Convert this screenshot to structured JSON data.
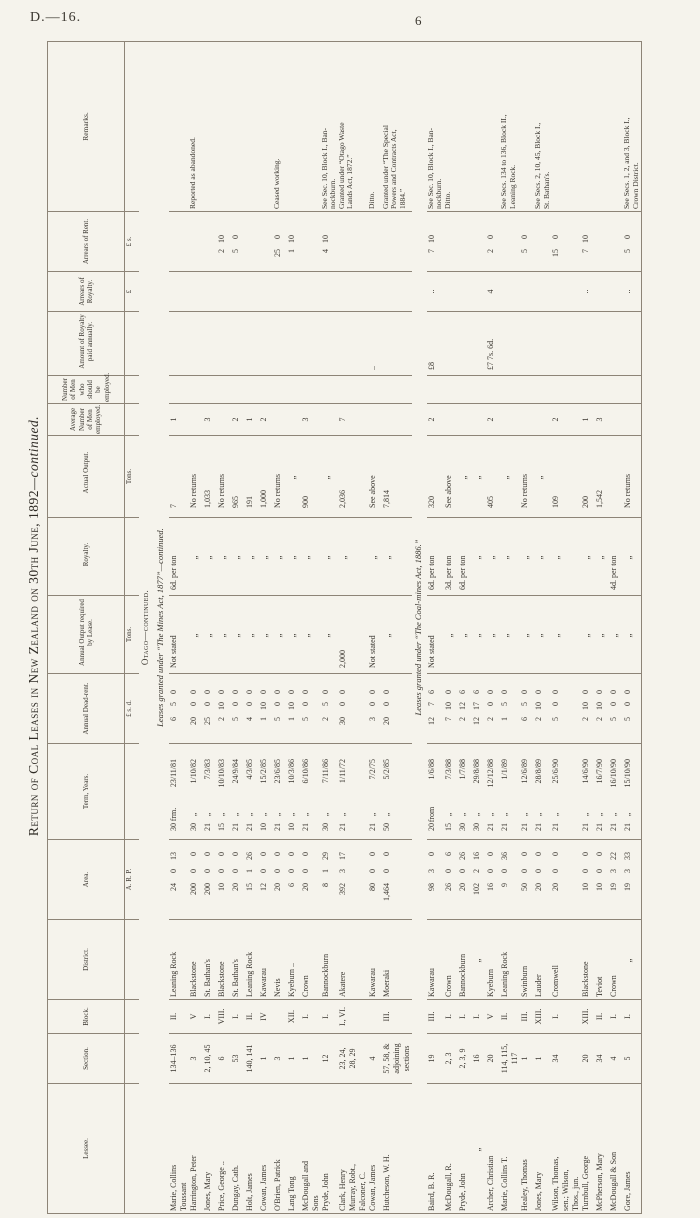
{
  "page": {
    "doc_ref": "D.—16.",
    "page_number": "6"
  },
  "title": {
    "main": "Return of Coal Leases in New Zealand on 30th June, 1892",
    "suffix": "—continued."
  },
  "table": {
    "column_keys": [
      "lessee",
      "section",
      "block",
      "district",
      "area",
      "term-years",
      "annual-dead-rent",
      "annual-output-required",
      "royalty",
      "actual-output",
      "average-men-employed",
      "men-should-be-employed",
      "royalty-paid-annually",
      "arrears-of-royalty",
      "arrears-of-rent",
      "remarks"
    ],
    "headers": [
      "Lessee.",
      "Section.",
      "Block.",
      "District.",
      "Area.",
      "Term, Years.",
      "Annual Dead-rent.",
      "Annual Output required by Lease.",
      "Royalty.",
      "Actual Output.",
      "Average Number of Men employed.",
      "Number of Men who should be employed.",
      "Amount of Royalty paid annually.",
      "Arrears of Royalty.",
      "Arrears of Rent.",
      "Remarks."
    ],
    "subheaders": [
      "",
      "",
      "",
      "",
      "A.   R.   P.",
      "",
      "£  s.  d.",
      "Tons.",
      "",
      "Tons.",
      "",
      "",
      "",
      "£",
      "£  s.",
      ""
    ],
    "caption_region": "Otago—continued.",
    "caption_group1": "Leases granted under “The Mines Act, 1877”—continued.",
    "caption_group2": "Leases granted under “The Coal-mines Act, 1886.”",
    "rows_group1": [
      [
        "Marie, Collins\n  Toussant",
        "134–136",
        "II.",
        "Leaning Rock",
        [
          "24",
          "0",
          "13"
        ],
        [
          "30",
          "frm.",
          "23/11/81"
        ],
        [
          "6",
          "5",
          "0"
        ],
        "Not stated",
        "6d. per ton",
        "7",
        "1",
        "",
        "",
        "",
        "",
        ""
      ],
      [
        "Harrington, Peter",
        "3",
        "V",
        "Blackstone",
        [
          "200",
          "0",
          "0"
        ],
        [
          "30",
          "„",
          "1/10/82"
        ],
        [
          "20",
          "0",
          "0"
        ],
        "„",
        "„",
        "No returns",
        "",
        "",
        "",
        "",
        "",
        "Reported as abandoned."
      ],
      [
        "Jones, Mary",
        "2, 10, 45",
        "I.",
        "St. Bathan's",
        [
          "200",
          "0",
          "0"
        ],
        [
          "21",
          "„",
          "7/3/83"
        ],
        [
          "25",
          "0",
          "0"
        ],
        "„",
        "„",
        "1,033",
        "3",
        "",
        "",
        "",
        "",
        ""
      ],
      [
        "Price, George ..",
        "6",
        "VIII.",
        "Blackstone",
        [
          "10",
          "0",
          "0"
        ],
        [
          "15",
          "„",
          "10/10/83"
        ],
        [
          "2",
          "10",
          "0"
        ],
        "„",
        "„",
        "No returns",
        "",
        "",
        "",
        "",
        [
          "2",
          "10"
        ],
        ""
      ],
      [
        "Dungay, Cath.",
        "53",
        "I.",
        "St. Bathan's",
        [
          "20",
          "0",
          "0"
        ],
        [
          "21",
          "„",
          "24/9/84"
        ],
        [
          "5",
          "0",
          "0"
        ],
        "„",
        "„",
        "965",
        "2",
        "",
        "",
        "",
        [
          "5",
          "0"
        ],
        ""
      ],
      [
        "Holt, James",
        "140, 141",
        "II.",
        "Leaning Rock",
        [
          "15",
          "1",
          "26"
        ],
        [
          "21",
          "„",
          "4/3/85"
        ],
        [
          "4",
          "0",
          "0"
        ],
        "„",
        "„",
        "191",
        "1",
        "",
        "",
        "",
        "",
        ""
      ],
      [
        "Cowan, James",
        "1",
        "IV",
        "Kawarau",
        [
          "12",
          "0",
          "0"
        ],
        [
          "10",
          "„",
          "15/2/85"
        ],
        [
          "1",
          "10",
          "0"
        ],
        "„",
        "„",
        "1,000",
        "2",
        "",
        "",
        "",
        "",
        ""
      ],
      [
        "O'Brien, Patrick",
        "3",
        "",
        "Nevis",
        [
          "20",
          "0",
          "0"
        ],
        [
          "21",
          "„",
          "23/6/85"
        ],
        [
          "5",
          "0",
          "0"
        ],
        "„",
        "„",
        "No returns",
        "",
        "",
        "",
        "",
        [
          "25",
          "0"
        ],
        "Ceased working."
      ],
      [
        "Lang Tong",
        "1",
        "XII.",
        "Kyeburn ..",
        [
          "6",
          "0",
          "0"
        ],
        [
          "10",
          "„",
          "10/3/86"
        ],
        [
          "1",
          "10",
          "0"
        ],
        "„",
        "„",
        "„",
        "",
        "",
        "",
        "",
        [
          "1",
          "10"
        ],
        ""
      ],
      [
        "McDougall and\n  Sons",
        "1",
        "I.",
        "Crown",
        [
          "20",
          "0",
          "0"
        ],
        [
          "21",
          "„",
          "6/10/86"
        ],
        [
          "5",
          "0",
          "0"
        ],
        "„",
        "„",
        "900",
        "3",
        "",
        "",
        "",
        "",
        ""
      ],
      [
        "Pryde, John",
        "12",
        "I.",
        "Bannockburn",
        [
          "8",
          "1",
          "29"
        ],
        [
          "30",
          "„",
          "7/11/86"
        ],
        [
          "2",
          "5",
          "0"
        ],
        "„",
        "„",
        "„",
        "",
        "",
        "",
        "",
        [
          "4",
          "10"
        ],
        "See Sec. 10, Block I., Ban-\n  nockburn."
      ],
      [
        "Clark, Henry\n  Murray, Robt.,\n  Falconer, C.",
        "23, 24,\n28, 29",
        "I., VI.",
        "Akatere",
        [
          "392",
          "3",
          "17"
        ],
        [
          "21",
          "„",
          "1/11/72"
        ],
        [
          "30",
          "0",
          "0"
        ],
        "2,000",
        "„",
        "2,036",
        "7",
        "",
        "",
        "",
        "",
        "Granted under “Otago Waste\n  Lands Act, 1872.”"
      ],
      [
        "Cowan, James",
        "4",
        "",
        "Kawarau",
        [
          "80",
          "0",
          "0"
        ],
        [
          "21",
          "„",
          "7/2/75"
        ],
        [
          "3",
          "0",
          "0"
        ],
        "Not stated",
        "„",
        "See above",
        "",
        "",
        "..",
        "",
        "",
        "Ditto."
      ],
      [
        "Hutcheson, W. H.",
        "57, 58, &\nadjoining\nsections",
        "III.",
        "Moeraki",
        [
          "1,464",
          "0",
          "0"
        ],
        [
          "50",
          "„",
          "5/2/85"
        ],
        [
          "20",
          "0",
          "0"
        ],
        "„",
        "„",
        "7,814",
        "",
        "",
        "",
        "",
        "",
        "Granted under “The Special\n  Powers and Contracts Act,\n  1884.”"
      ]
    ],
    "rows_group2": [
      [
        "Baird, B. R.",
        "19",
        "III.",
        "Kawarau",
        [
          "98",
          "3",
          "0"
        ],
        [
          "20",
          "from",
          "1/6/88"
        ],
        [
          "12",
          "7",
          "6"
        ],
        "Not stated",
        "6d. per ton",
        "320",
        "2",
        "",
        "£8",
        "..",
        [
          "7",
          "10"
        ],
        "See Sec. 10, Block I., Ban-\n  nockburn."
      ],
      [
        "McDougall, R.",
        "2, 3",
        "I.",
        "Crown",
        [
          "26",
          "0",
          "6"
        ],
        [
          "15",
          "„",
          "7/3/88"
        ],
        [
          "7",
          "10",
          "0"
        ],
        "„",
        "3d. per ton",
        "See above",
        "",
        "",
        "",
        "",
        "",
        "Ditto."
      ],
      [
        "Pryde, John",
        "2, 3, 9",
        "I.",
        "Bannockburn",
        [
          "20",
          "0",
          "26"
        ],
        [
          "30",
          "„",
          "1/7/88"
        ],
        [
          "2",
          "12",
          "6"
        ],
        "„",
        "6d. per ton",
        "„",
        "",
        "",
        "",
        "",
        "",
        ""
      ],
      [
        "„",
        "16",
        "I.",
        "„",
        [
          "102",
          "2",
          "16"
        ],
        [
          "30",
          "„",
          "29/8/88"
        ],
        [
          "12",
          "17",
          "6"
        ],
        "„",
        "„",
        "„",
        "",
        "",
        "",
        "",
        "",
        ""
      ],
      [
        "Archer, Christian",
        "20",
        "V",
        "Kyeburn",
        [
          "16",
          "0",
          "0"
        ],
        [
          "21",
          "„",
          "12/12/88"
        ],
        [
          "2",
          "0",
          "0"
        ],
        "„",
        "„",
        "405",
        "2",
        "",
        "£7 7s. 6d.",
        "4",
        [
          "2",
          "0"
        ],
        ""
      ],
      [
        "Marie, Collins T.",
        "114, 115,\n117",
        "II.",
        "Leaning Rock",
        [
          "9",
          "0",
          "36"
        ],
        [
          "21",
          "„",
          "1/1/89"
        ],
        [
          "1",
          "5",
          "0"
        ],
        "„",
        "„",
        "„",
        "",
        "",
        "",
        "",
        "",
        "See Secs. 134 to 136, Block II.,\n  Leaning Rock."
      ],
      [
        "Healey, Thomas",
        "1",
        "III.",
        "Swinburn",
        [
          "50",
          "0",
          "0"
        ],
        [
          "21",
          "„",
          "12/6/89"
        ],
        [
          "6",
          "5",
          "0"
        ],
        "„",
        "„",
        "No returns",
        "",
        "",
        "",
        "",
        [
          "5",
          "0"
        ],
        ""
      ],
      [
        "Jones, Mary",
        "1",
        "XIII.",
        "Lauder",
        [
          "20",
          "0",
          "0"
        ],
        [
          "21",
          "„",
          "28/8/89"
        ],
        [
          "2",
          "10",
          "0"
        ],
        "„",
        "„",
        "„",
        "",
        "",
        "",
        "",
        "",
        "See Secs. 2, 10, 45, Block I.,\n  St. Bathan's."
      ],
      [
        "Wilson, Thomas,\n  sen.; Wilson,\n  Thos., jun.",
        "34",
        "I.",
        "Cromwell",
        [
          "20",
          "0",
          "0"
        ],
        [
          "21",
          "„",
          "25/6/90"
        ],
        [
          "5",
          "0",
          "0"
        ],
        "„",
        "„",
        "109",
        "2",
        "",
        "",
        "",
        [
          "15",
          "0"
        ],
        ""
      ],
      [
        "Turnbull, George",
        "20",
        "XIII.",
        "Blackstone",
        [
          "10",
          "0",
          "0"
        ],
        [
          "21",
          "„",
          "14/6/90"
        ],
        [
          "2",
          "10",
          "0"
        ],
        "„",
        "„",
        "200",
        "1",
        "",
        "",
        "..",
        [
          "7",
          "10"
        ],
        ""
      ],
      [
        "McPherson, Mary",
        "34",
        "II.",
        "Teviot",
        [
          "10",
          "0",
          "0"
        ],
        [
          "21",
          "„",
          "16/7/90"
        ],
        [
          "2",
          "10",
          "0"
        ],
        "„",
        "„",
        "1,542",
        "3",
        "",
        "",
        "",
        "",
        ""
      ],
      [
        "McDougall & Son",
        "4",
        "I.",
        "Crown",
        [
          "19",
          "3",
          "22"
        ],
        [
          "21",
          "„",
          "16/10/90"
        ],
        [
          "5",
          "0",
          "0"
        ],
        "„",
        "4d. per ton",
        "",
        "",
        "",
        "",
        "",
        "",
        ""
      ],
      [
        "Gore, James",
        "5",
        "I.",
        "„",
        [
          "19",
          "3",
          "33"
        ],
        [
          "21",
          "„",
          "15/10/90"
        ],
        [
          "5",
          "0",
          "0"
        ],
        "„",
        "„",
        "No returns",
        "",
        "",
        "",
        "..",
        [
          "5",
          "0"
        ],
        "See Secs. 1, 2, and 3, Block I.,\n  Crown District."
      ]
    ]
  }
}
